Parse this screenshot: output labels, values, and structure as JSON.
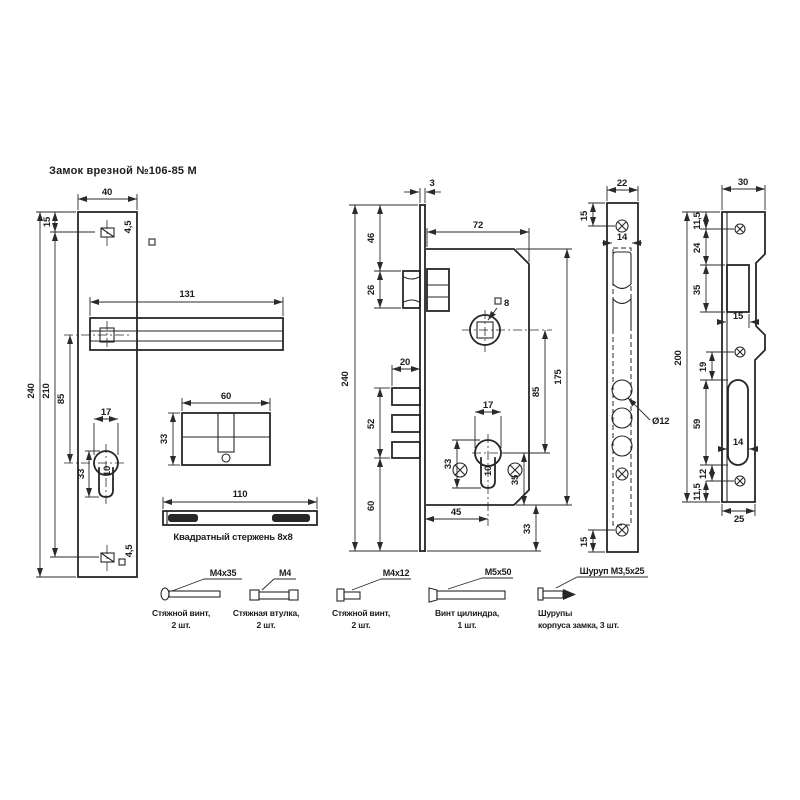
{
  "title": "Замок врезной №106-85 М",
  "left_view": {
    "width": "40",
    "top_offset": "15",
    "handle_length": "131",
    "height": "240",
    "holes_span": "210",
    "axis_to_keyhole": "85",
    "keyhole_width": "17",
    "keyhole_height": "33",
    "keyhole_slot": "10",
    "hole_top": "4,5",
    "hole_bottom": "4,5"
  },
  "cylinder_view": {
    "length": "60",
    "height": "33"
  },
  "rod_view": {
    "length": "110",
    "caption": "Квадратный стержень 8х8"
  },
  "body_view": {
    "faceplate_thk": "3",
    "top_to_latch": "46",
    "latch_height": "26",
    "depth": "72",
    "follower_square": "8",
    "bolt_throw": "20",
    "bolt_block": "52",
    "bolt_to_bottom": "60",
    "height": "240",
    "cyl_width": "17",
    "cyl_height": "33",
    "cyl_slot": "10",
    "cyl_to_bottom": "35",
    "backset": "45",
    "bottom_margin": "33",
    "follower_to_cyl": "85",
    "case_height": "175"
  },
  "faceplate_view": {
    "width": "22",
    "top_offset": "15",
    "slot_width": "14",
    "hole_dia": "Ø12",
    "bottom_offset": "15"
  },
  "strike_view": {
    "width": "30",
    "top_offset": "11,5",
    "to_latch": "24",
    "latch_opening": "35",
    "latch_width": "15",
    "gap": "19",
    "bolt_opening": "59",
    "bolt_width": "14",
    "below_opening": "12",
    "bottom_offset": "11,5",
    "height": "200",
    "bottom_width": "25"
  },
  "hardware": [
    {
      "label": "М4х35",
      "line1": "Стяжной винт,",
      "line2": "2 шт."
    },
    {
      "label": "М4",
      "line1": "Стяжная втулка,",
      "line2": "2 шт."
    },
    {
      "label": "М4х12",
      "line1": "Стяжной винт,",
      "line2": "2 шт."
    },
    {
      "label": "М5х50",
      "line1": "Винт цилиндра,",
      "line2": "1 шт."
    },
    {
      "label": "Шуруп М3,5х25",
      "line1": "Шурупы",
      "line2": "корпуса замка, 3 шт."
    }
  ]
}
